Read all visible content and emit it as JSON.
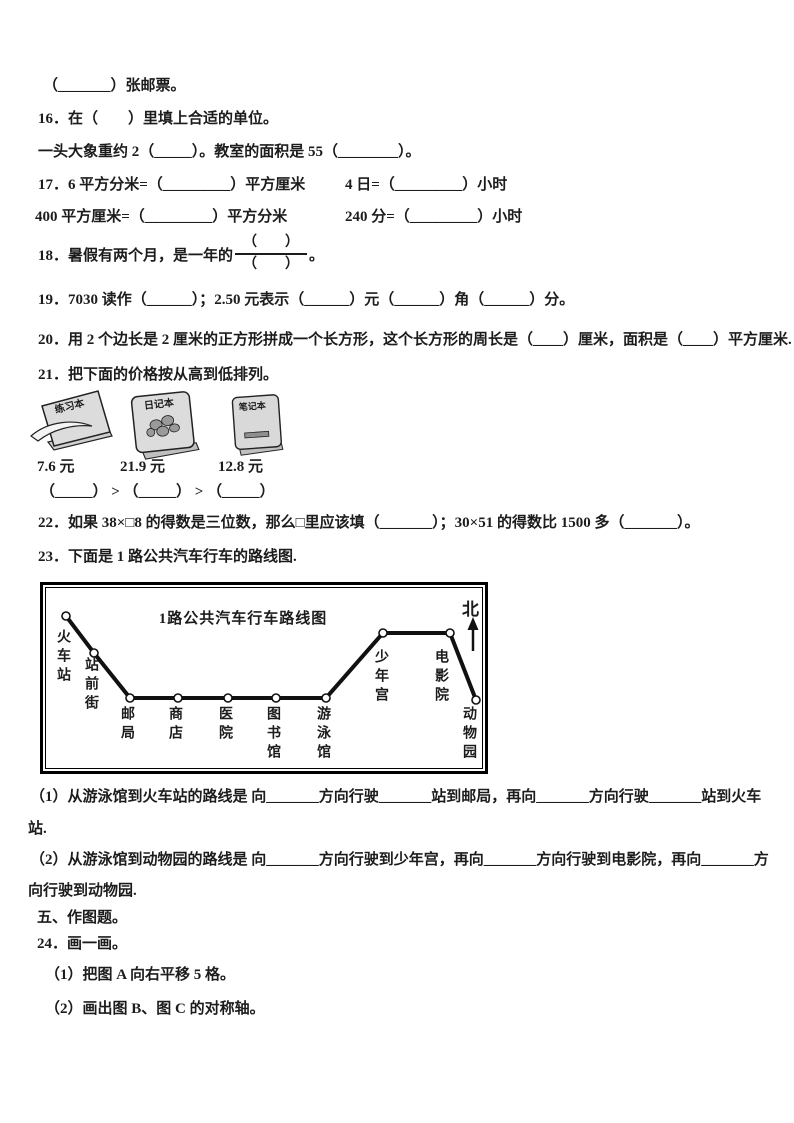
{
  "doc": {
    "stamp_line": "（_______）张邮票。",
    "q16": {
      "text": "16．在（　　）里填上合适的单位。",
      "sub": "一头大象重约 2（_____）。教室的面积是 55（________）。"
    },
    "q17": {
      "row1_left": "17．6 平方分米=（_________）平方厘米",
      "row1_right": "4 日=（_________）小时",
      "row2_left": "400 平方厘米=（_________）平方分米",
      "row2_right": "240 分=（_________）小时"
    },
    "q18": {
      "prefix": "18．暑假有两个月，是一年的",
      "frac_top": "（　　）",
      "frac_bottom": "（　　）",
      "suffix": "。"
    },
    "q19": "19．7030 读作（______）；2.50 元表示（______）元（______）角（______）分。",
    "q20": "20．用 2 个边长是 2 厘米的正方形拼成一个长方形，这个长方形的周长是（____）厘米，面积是（____）平方厘米.",
    "q21": {
      "text": "21．把下面的价格按从高到低排列。",
      "items": [
        {
          "label": "练习本",
          "price": "7.6 元"
        },
        {
          "label": "日记本",
          "price": "21.9 元"
        },
        {
          "label": "笔记本",
          "price": "12.8 元"
        }
      ],
      "compare": "（_____） > （_____） > （_____）"
    },
    "q22": "22．如果 38×□8 的得数是三位数，那么□里应该填（_______）；30×51 的得数比 1500 多（_______）。",
    "q23": {
      "text": "23．下面是 1 路公共汽车行车的路线图.",
      "diagram": {
        "title": "1路公共汽车行车路线图",
        "north": "北",
        "stations": [
          {
            "label": "火车站",
            "x": 23,
            "y": 31,
            "lx": 12,
            "ly": 44
          },
          {
            "label": "站前街",
            "x": 51,
            "y": 68,
            "lx": 40,
            "ly": 72
          },
          {
            "label": "邮局",
            "x": 87,
            "y": 113,
            "lx": 76,
            "ly": 121
          },
          {
            "label": "商店",
            "x": 135,
            "y": 113,
            "lx": 124,
            "ly": 121
          },
          {
            "label": "医院",
            "x": 185,
            "y": 113,
            "lx": 174,
            "ly": 121
          },
          {
            "label": "图书馆",
            "x": 233,
            "y": 113,
            "lx": 222,
            "ly": 121
          },
          {
            "label": "游泳馆",
            "x": 283,
            "y": 113,
            "lx": 272,
            "ly": 121
          },
          {
            "label": "少年宫",
            "x": 340,
            "y": 48,
            "lx": 330,
            "ly": 64
          },
          {
            "label": "电影院",
            "x": 407,
            "y": 48,
            "lx": 390,
            "ly": 64
          },
          {
            "label": "动物园",
            "x": 433,
            "y": 115,
            "lx": 418,
            "ly": 121
          }
        ]
      },
      "part1_line1": "（1）从游泳馆到火车站的路线是 向_______方向行驶_______站到邮局，再向_______方向行驶_______站到火车",
      "part1_line2": "站.",
      "part2_line1": "（2）从游泳馆到动物园的路线是 向_______方向行驶到少年宫，再向_______方向行驶到电影院，再向_______方",
      "part2_line2": "向行驶到动物园.",
      "part2_line2b": ""
    },
    "section5": "五、作图题。",
    "q24": {
      "text": "24．画一画。",
      "part1": "（1）把图 A 向右平移 5 格。",
      "part2": "（2）画出图 B、图 C 的对称轴。"
    }
  }
}
